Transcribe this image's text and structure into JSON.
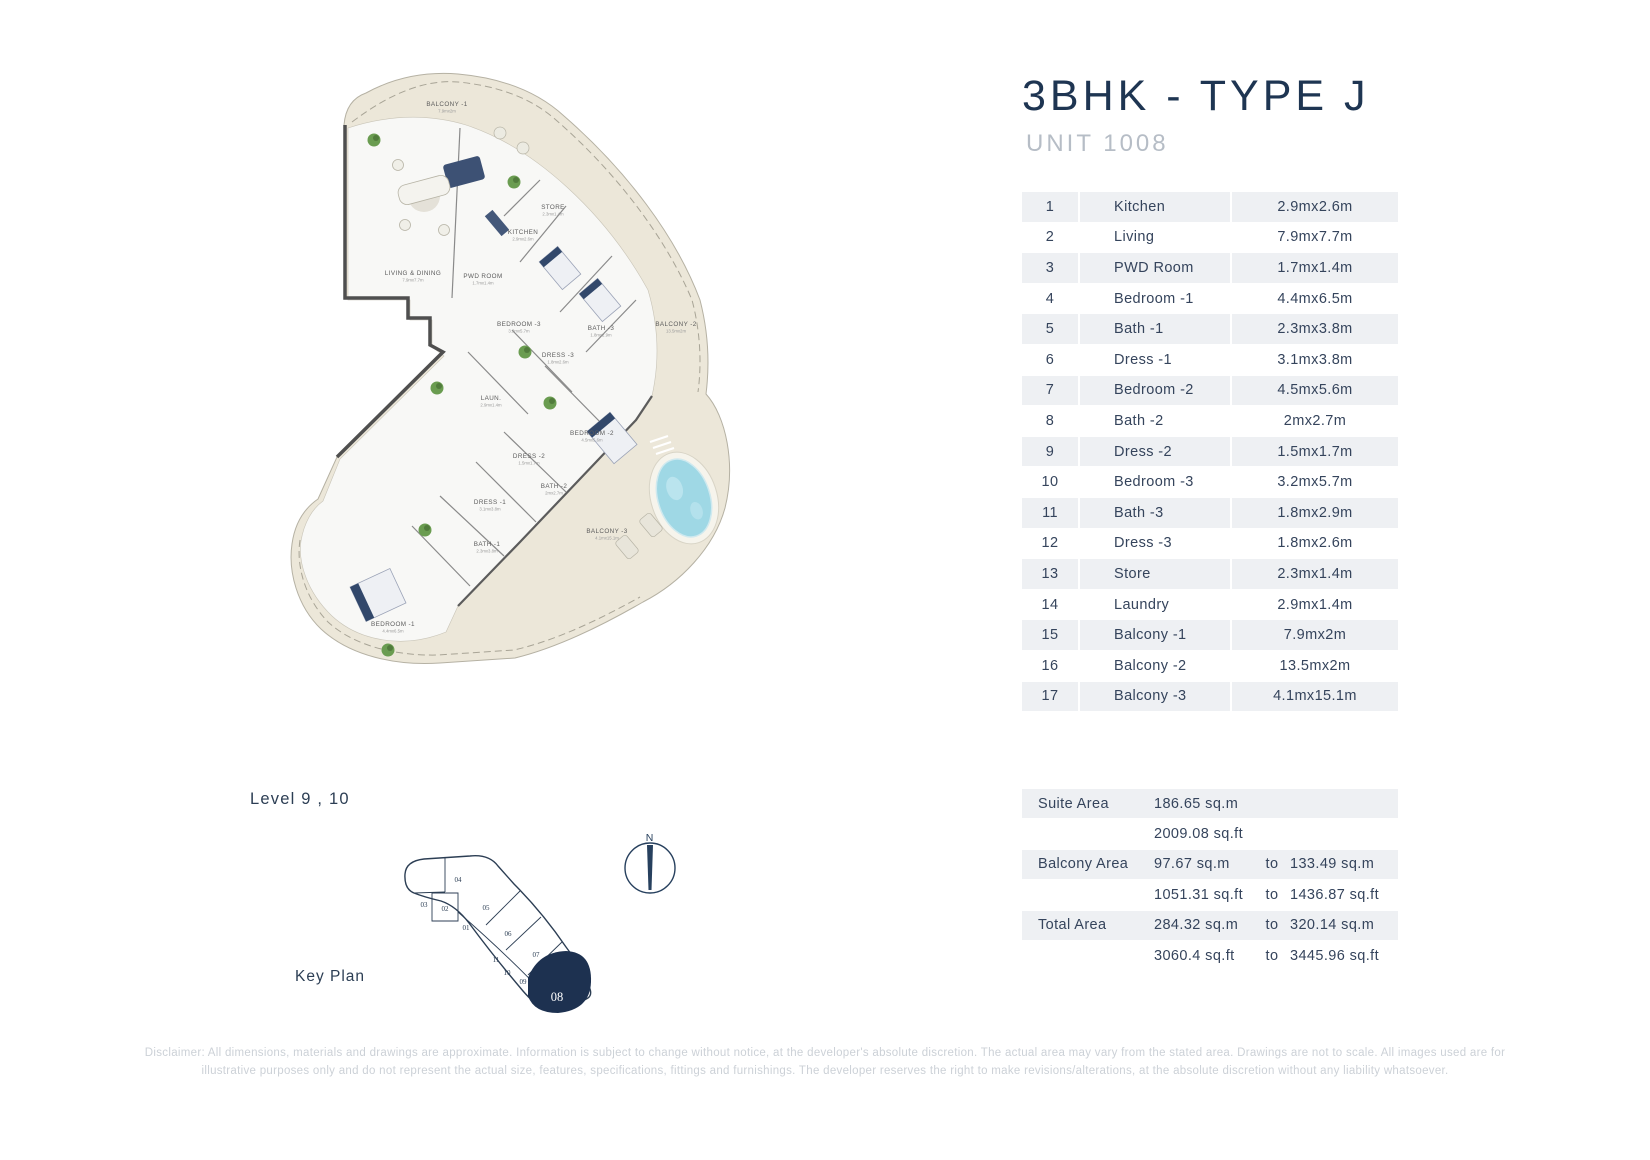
{
  "title": "3BHK - TYPE J",
  "subtitle": "UNIT 1008",
  "rooms_table": {
    "rows": [
      {
        "no": "1",
        "name": "Kitchen",
        "dims": "2.9mx2.6m"
      },
      {
        "no": "2",
        "name": "Living",
        "dims": "7.9mx7.7m"
      },
      {
        "no": "3",
        "name": "PWD Room",
        "dims": "1.7mx1.4m"
      },
      {
        "no": "4",
        "name": "Bedroom -1",
        "dims": "4.4mx6.5m"
      },
      {
        "no": "5",
        "name": "Bath -1",
        "dims": "2.3mx3.8m"
      },
      {
        "no": "6",
        "name": "Dress -1",
        "dims": "3.1mx3.8m"
      },
      {
        "no": "7",
        "name": "Bedroom -2",
        "dims": "4.5mx5.6m"
      },
      {
        "no": "8",
        "name": "Bath -2",
        "dims": "2mx2.7m"
      },
      {
        "no": "9",
        "name": "Dress -2",
        "dims": "1.5mx1.7m"
      },
      {
        "no": "10",
        "name": "Bedroom -3",
        "dims": "3.2mx5.7m"
      },
      {
        "no": "11",
        "name": "Bath -3",
        "dims": "1.8mx2.9m"
      },
      {
        "no": "12",
        "name": "Dress -3",
        "dims": "1.8mx2.6m"
      },
      {
        "no": "13",
        "name": "Store",
        "dims": "2.3mx1.4m"
      },
      {
        "no": "14",
        "name": "Laundry",
        "dims": "2.9mx1.4m"
      },
      {
        "no": "15",
        "name": "Balcony -1",
        "dims": "7.9mx2m"
      },
      {
        "no": "16",
        "name": "Balcony -2",
        "dims": "13.5mx2m"
      },
      {
        "no": "17",
        "name": "Balcony -3",
        "dims": "4.1mx15.1m"
      }
    ]
  },
  "area_table": {
    "rows": [
      {
        "label": "Suite Area",
        "v1": "186.65 sq.m",
        "to": "",
        "v2": ""
      },
      {
        "label": "",
        "v1": "2009.08 sq.ft",
        "to": "",
        "v2": ""
      },
      {
        "label": "Balcony Area",
        "v1": "97.67 sq.m",
        "to": "to",
        "v2": "133.49 sq.m"
      },
      {
        "label": "",
        "v1": "1051.31 sq.ft",
        "to": "to",
        "v2": "1436.87 sq.ft"
      },
      {
        "label": "Total Area",
        "v1": "284.32 sq.m",
        "to": "to",
        "v2": "320.14 sq.m"
      },
      {
        "label": "",
        "v1": "3060.4 sq.ft",
        "to": "to",
        "v2": "3445.96 sq.ft"
      }
    ]
  },
  "key_plan": {
    "level_label": "Level  9 , 10",
    "caption": "Key Plan",
    "highlight_unit": "08",
    "units": [
      {
        "no": "04",
        "x": 458,
        "y": 882
      },
      {
        "no": "03",
        "x": 424,
        "y": 907
      },
      {
        "no": "02",
        "x": 445,
        "y": 911
      },
      {
        "no": "05",
        "x": 486,
        "y": 910
      },
      {
        "no": "01",
        "x": 466,
        "y": 930
      },
      {
        "no": "06",
        "x": 508,
        "y": 936
      },
      {
        "no": "11",
        "x": 496,
        "y": 962
      },
      {
        "no": "07",
        "x": 536,
        "y": 957
      },
      {
        "no": "10",
        "x": 507,
        "y": 975
      },
      {
        "no": "09",
        "x": 523,
        "y": 984
      }
    ]
  },
  "compass": {
    "label": "N"
  },
  "floor_plan": {
    "labels": [
      {
        "id": "balcony-1",
        "name": "BALCONY -1",
        "dims": "7.9mx2m",
        "x": 447,
        "y": 106
      },
      {
        "id": "store",
        "name": "STORE",
        "dims": "2.3mx1.4m",
        "x": 553,
        "y": 209
      },
      {
        "id": "kitchen",
        "name": "KITCHEN",
        "dims": "2.9mx2.6m",
        "x": 523,
        "y": 234
      },
      {
        "id": "living-dining",
        "name": "LIVING & DINING",
        "dims": "7.9mx7.7m",
        "x": 413,
        "y": 275
      },
      {
        "id": "pwd-room",
        "name": "PWD ROOM",
        "dims": "1.7mx1.4m",
        "x": 483,
        "y": 278
      },
      {
        "id": "bedroom-3",
        "name": "BEDROOM -3",
        "dims": "3.2mx5.7m",
        "x": 519,
        "y": 326
      },
      {
        "id": "bath-3",
        "name": "BATH -3",
        "dims": "1.8mx2.9m",
        "x": 601,
        "y": 330
      },
      {
        "id": "balcony-2",
        "name": "BALCONY -2",
        "dims": "13.5mx2m",
        "x": 676,
        "y": 326
      },
      {
        "id": "dress-3",
        "name": "DRESS -3",
        "dims": "1.8mx2.6m",
        "x": 558,
        "y": 357
      },
      {
        "id": "laundry",
        "name": "LAUN.",
        "dims": "2.9mx1.4m",
        "x": 491,
        "y": 400
      },
      {
        "id": "bedroom-2",
        "name": "BEDROOM -2",
        "dims": "4.5mx5.6m",
        "x": 592,
        "y": 435
      },
      {
        "id": "dress-2",
        "name": "DRESS -2",
        "dims": "1.5mx1.7m",
        "x": 529,
        "y": 458
      },
      {
        "id": "bath-2",
        "name": "BATH -2",
        "dims": "2mx2.7m",
        "x": 554,
        "y": 488
      },
      {
        "id": "dress-1",
        "name": "DRESS -1",
        "dims": "3.1mx3.8m",
        "x": 490,
        "y": 504
      },
      {
        "id": "bath-1",
        "name": "BATH -1",
        "dims": "2.3mx3.8m",
        "x": 487,
        "y": 546
      },
      {
        "id": "balcony-3",
        "name": "BALCONY -3",
        "dims": "4.1mx15.1m",
        "x": 607,
        "y": 533
      },
      {
        "id": "bedroom-1",
        "name": "BEDROOM -1",
        "dims": "4.4mx6.5m",
        "x": 393,
        "y": 626
      }
    ]
  },
  "disclaimer": {
    "line1": "Disclaimer: All dimensions, materials and drawings are approximate. Information is subject to change without notice, at the developer's absolute discretion. The actual area may vary from the stated area. Drawings are not to scale. All images used are for",
    "line2": "illustrative purposes only and do not represent the actual size, features, specifications, fittings and furnishings. The developer reserves the right to make revisions/alterations, at the absolute discretion without any liability whatsoever."
  },
  "colors": {
    "accent": "#1e3552",
    "subtitle_gray": "#b6bdc6",
    "table_row_bg": "#eef0f3",
    "table_text": "#35445c",
    "plan_beige": "#ece7d9",
    "plan_interior": "#f8f8f6",
    "pool_blue": "#9fd8e5",
    "key_navy": "#1d3150",
    "disclaimer_gray": "#ccd1d7"
  }
}
